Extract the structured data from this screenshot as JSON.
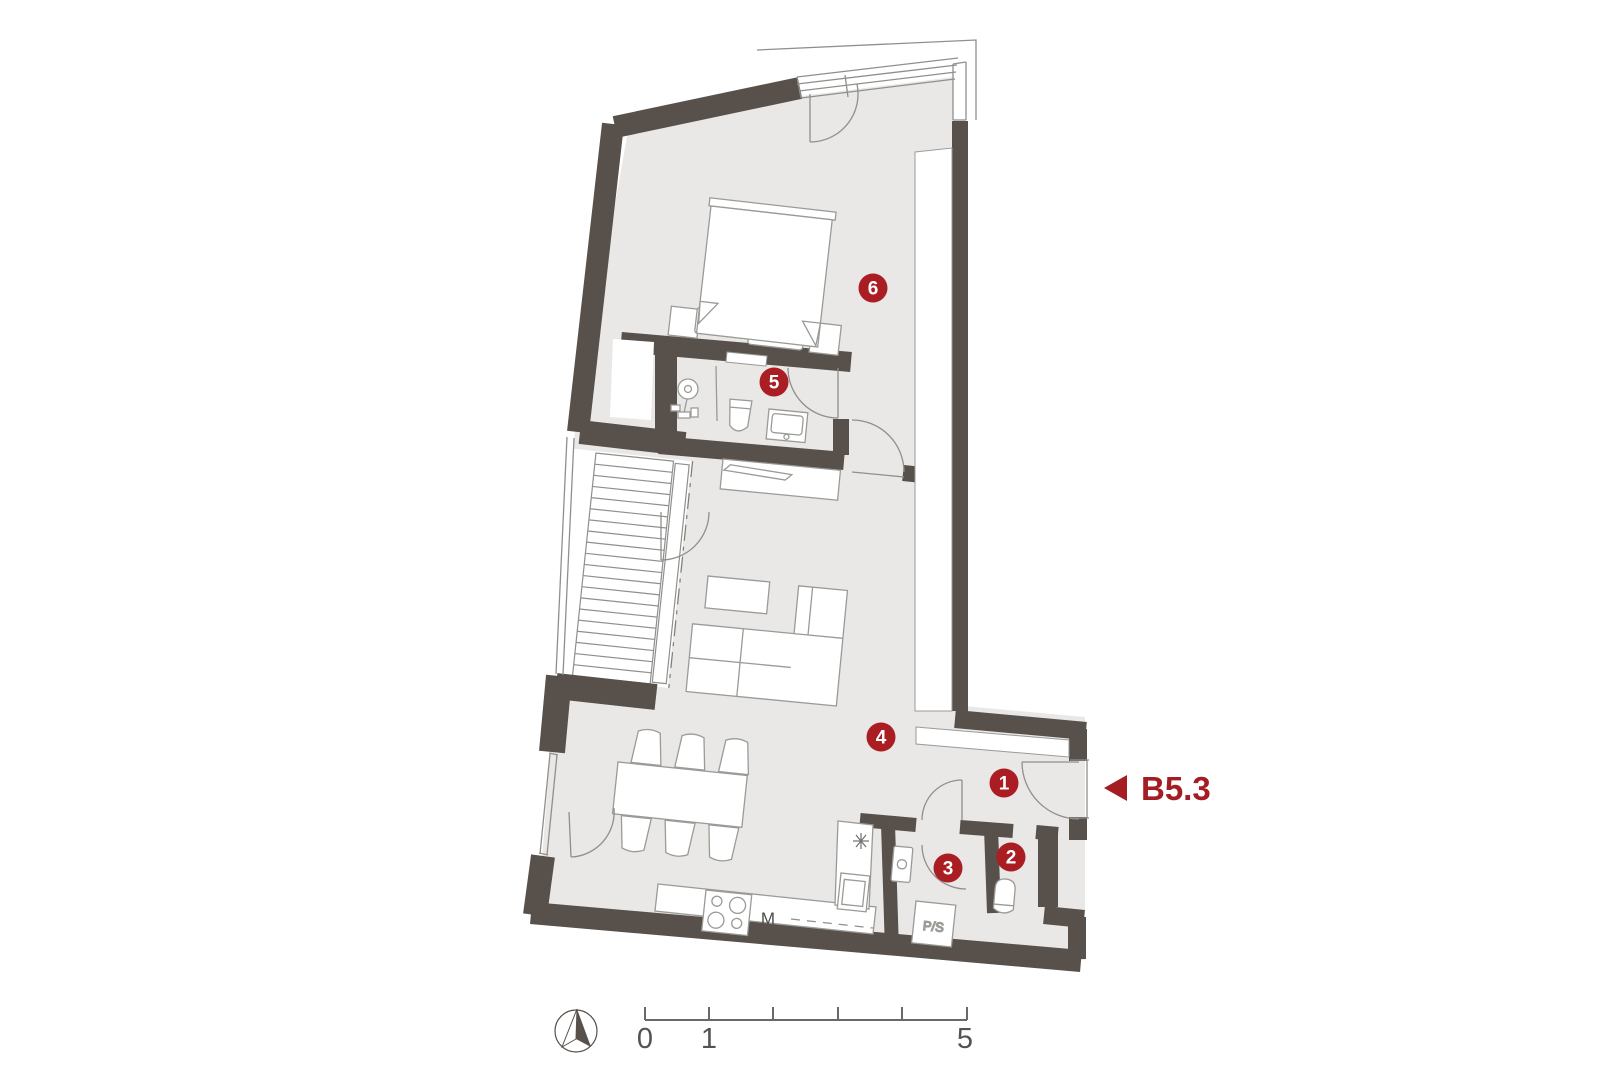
{
  "document": {
    "type": "architectural floor plan",
    "unit_code": "B5.3"
  },
  "room_markers": [
    {
      "number": "1"
    },
    {
      "number": "2"
    },
    {
      "number": "3"
    },
    {
      "number": "4"
    },
    {
      "number": "5"
    },
    {
      "number": "6"
    }
  ],
  "appliance_labels": {
    "dishwasher": "M",
    "washer_dryer": "P/S"
  },
  "scale_bar": {
    "labels": [
      "0",
      "1",
      "5"
    ]
  },
  "icons": [
    "north-arrow-icon",
    "unit-direction-arrow-icon"
  ],
  "colors": {
    "wall": "#57504b",
    "floor": "#e9e8e6",
    "accent_red": "#a91d23",
    "thin_line": "#8f8f8c"
  }
}
